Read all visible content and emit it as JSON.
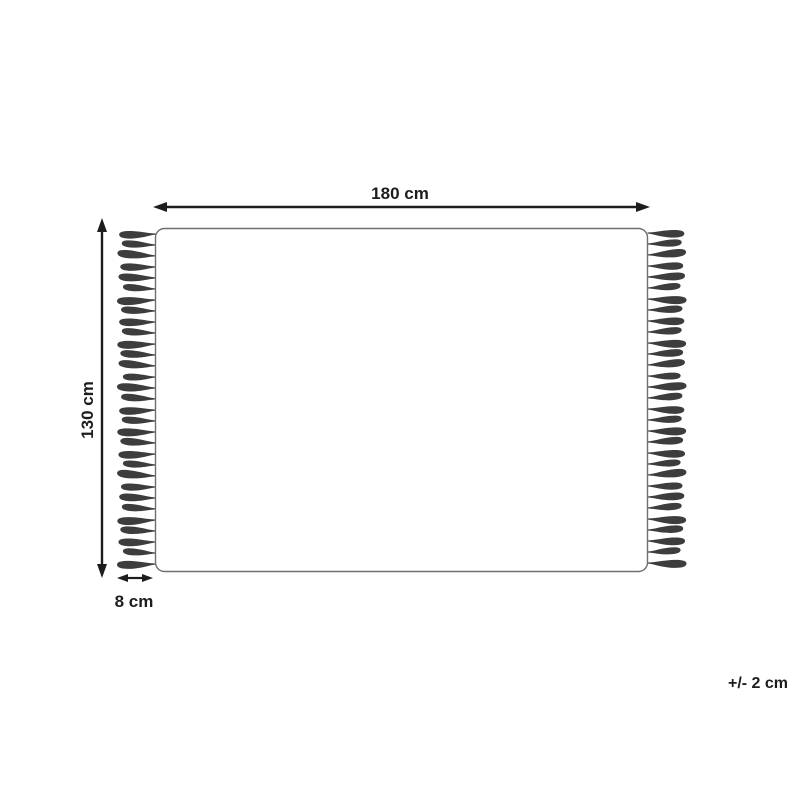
{
  "diagram": {
    "type": "product-dimension-diagram",
    "subject": "rug with fringe on left and right sides",
    "labels": {
      "width": "180 cm",
      "height": "130 cm",
      "fringe_length": "8 cm",
      "tolerance": "+/- 2 cm"
    },
    "colors": {
      "line": "#1d1d1b",
      "rug_outline": "#6f6f6f",
      "tassel": "#3d3d3d",
      "background": "#ffffff"
    },
    "fringe": {
      "sides": [
        "left",
        "right"
      ],
      "tassels_per_side": 31
    }
  }
}
